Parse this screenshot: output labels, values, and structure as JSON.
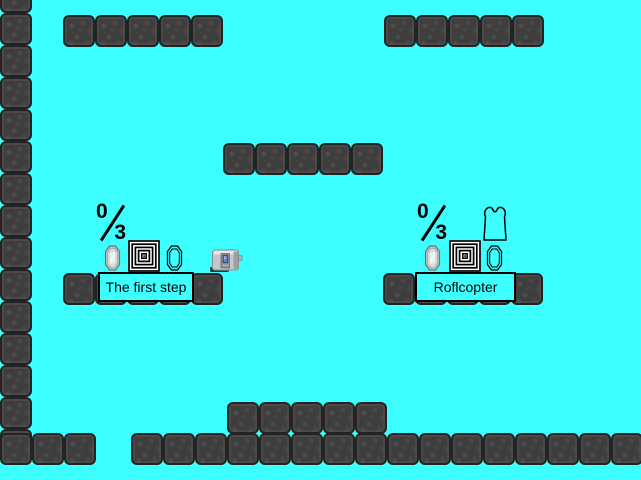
{
  "scene": {
    "width": 641,
    "height": 480,
    "colors": {
      "background": "#3DFFFF",
      "block": "#3E3E3E",
      "block_border": "#232323",
      "label_border": "#000000",
      "text": "#000000",
      "spiral_bg": "#FFFFFF",
      "gem_fill": "#BCC3C3",
      "toaster_body": "#C4C8CA",
      "toaster_screen": "#6C86C8"
    },
    "platforms": [
      {
        "name": "left-wall",
        "x": 0,
        "y": -19,
        "dir": "v",
        "count": 15
      },
      {
        "name": "top-left-platform",
        "x": 63,
        "y": 15,
        "dir": "h",
        "count": 5
      },
      {
        "name": "top-right-platform",
        "x": 384,
        "y": 15,
        "dir": "h",
        "count": 5
      },
      {
        "name": "middle-platform",
        "x": 223,
        "y": 143,
        "dir": "h",
        "count": 5
      },
      {
        "name": "level1-platform",
        "x": 63,
        "y": 273,
        "dir": "h",
        "count": 5
      },
      {
        "name": "level2-platform",
        "x": 383,
        "y": 273,
        "dir": "h",
        "count": 5
      },
      {
        "name": "bottom-raised-platform",
        "x": 227,
        "y": 402,
        "dir": "h",
        "count": 5
      },
      {
        "name": "bottom-left-ledge",
        "x": 0,
        "y": 433,
        "dir": "h",
        "count": 3
      },
      {
        "name": "bottom-floor",
        "x": 131,
        "y": 433,
        "dir": "h",
        "count": 16
      }
    ]
  },
  "levels": [
    {
      "name": "The first step",
      "secrets_current": "0",
      "secrets_total": "3",
      "icons": [
        "gem-filled",
        "spiral-portal",
        "gem-outline",
        "toaster"
      ]
    },
    {
      "name": "Roflcopter",
      "secrets_current": "0",
      "secrets_total": "3",
      "icons": [
        "shirt-outline",
        "gem-filled",
        "spiral-portal",
        "gem-outline"
      ]
    }
  ]
}
